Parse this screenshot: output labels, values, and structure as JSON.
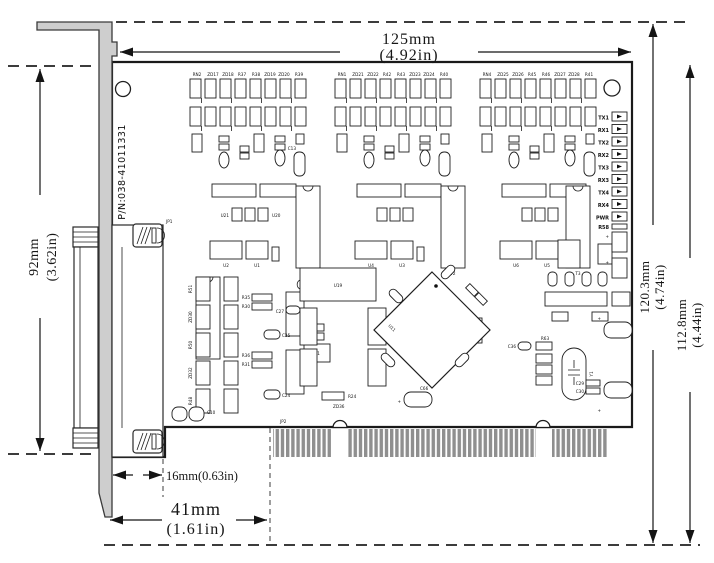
{
  "diagram": {
    "part_number": "P/N:038-41011331",
    "dimensions": {
      "width_top": {
        "mm": "125mm",
        "inch": "(4.92in)"
      },
      "height_left": {
        "mm": "92mm",
        "inch": "(3.62in)"
      },
      "height_right_outer": {
        "mm": "120.3mm",
        "inch": "(4.74in)"
      },
      "height_right_inner": {
        "mm": "112.8mm",
        "inch": "(4.44in)"
      },
      "offset_small": "16mm(0.63in)",
      "offset_connector": {
        "mm": "41mm",
        "inch": "(1.61in)"
      }
    },
    "connectors": {
      "jp1": "JP1",
      "jp2": "JP2"
    },
    "leds": [
      "TX1",
      "RX1",
      "TX2",
      "RX2",
      "TX3",
      "RX3",
      "TX4",
      "RX4",
      "PWR"
    ],
    "iso_groups": [
      {
        "labels": [
          "RN2",
          "ZD17",
          "ZD18",
          "R37",
          "R38",
          "ZD19",
          "ZD20",
          "R39"
        ]
      },
      {
        "labels": [
          "RN1",
          "ZD21",
          "ZD22",
          "R42",
          "R43",
          "ZD23",
          "ZD24",
          "R40"
        ]
      },
      {
        "labels": [
          "RN4",
          "ZD25",
          "ZD26",
          "R45",
          "R46",
          "ZD27",
          "ZD28",
          "R41"
        ]
      }
    ],
    "ic_labels": {
      "g1a": "U2",
      "g1b": "U1",
      "t1": "T1",
      "g2a": "U4",
      "g2b": "U3",
      "t2": "T2",
      "g3a": "U6",
      "g3b": "U5",
      "t3": "T3",
      "u19": "U19",
      "u21": "U21",
      "u20": "U20",
      "u11": "U11",
      "y1": "Y1"
    },
    "small_parts": {
      "c10": "C10",
      "c13": "C13",
      "c24": "C24",
      "c25": "C25",
      "c27": "C27",
      "c29": "C29",
      "c30": "C30",
      "c36": "C36",
      "c66": "C66",
      "d1": "D1",
      "r24": "R24",
      "r58": "R58",
      "r63": "R63",
      "zd36": "ZD36",
      "plus": "+"
    },
    "left_column_labels": [
      "R51",
      "ZD30",
      "R50",
      "ZD32",
      "R48"
    ],
    "pair_labels": [
      "R35",
      "R30",
      "R36",
      "R31"
    ]
  }
}
